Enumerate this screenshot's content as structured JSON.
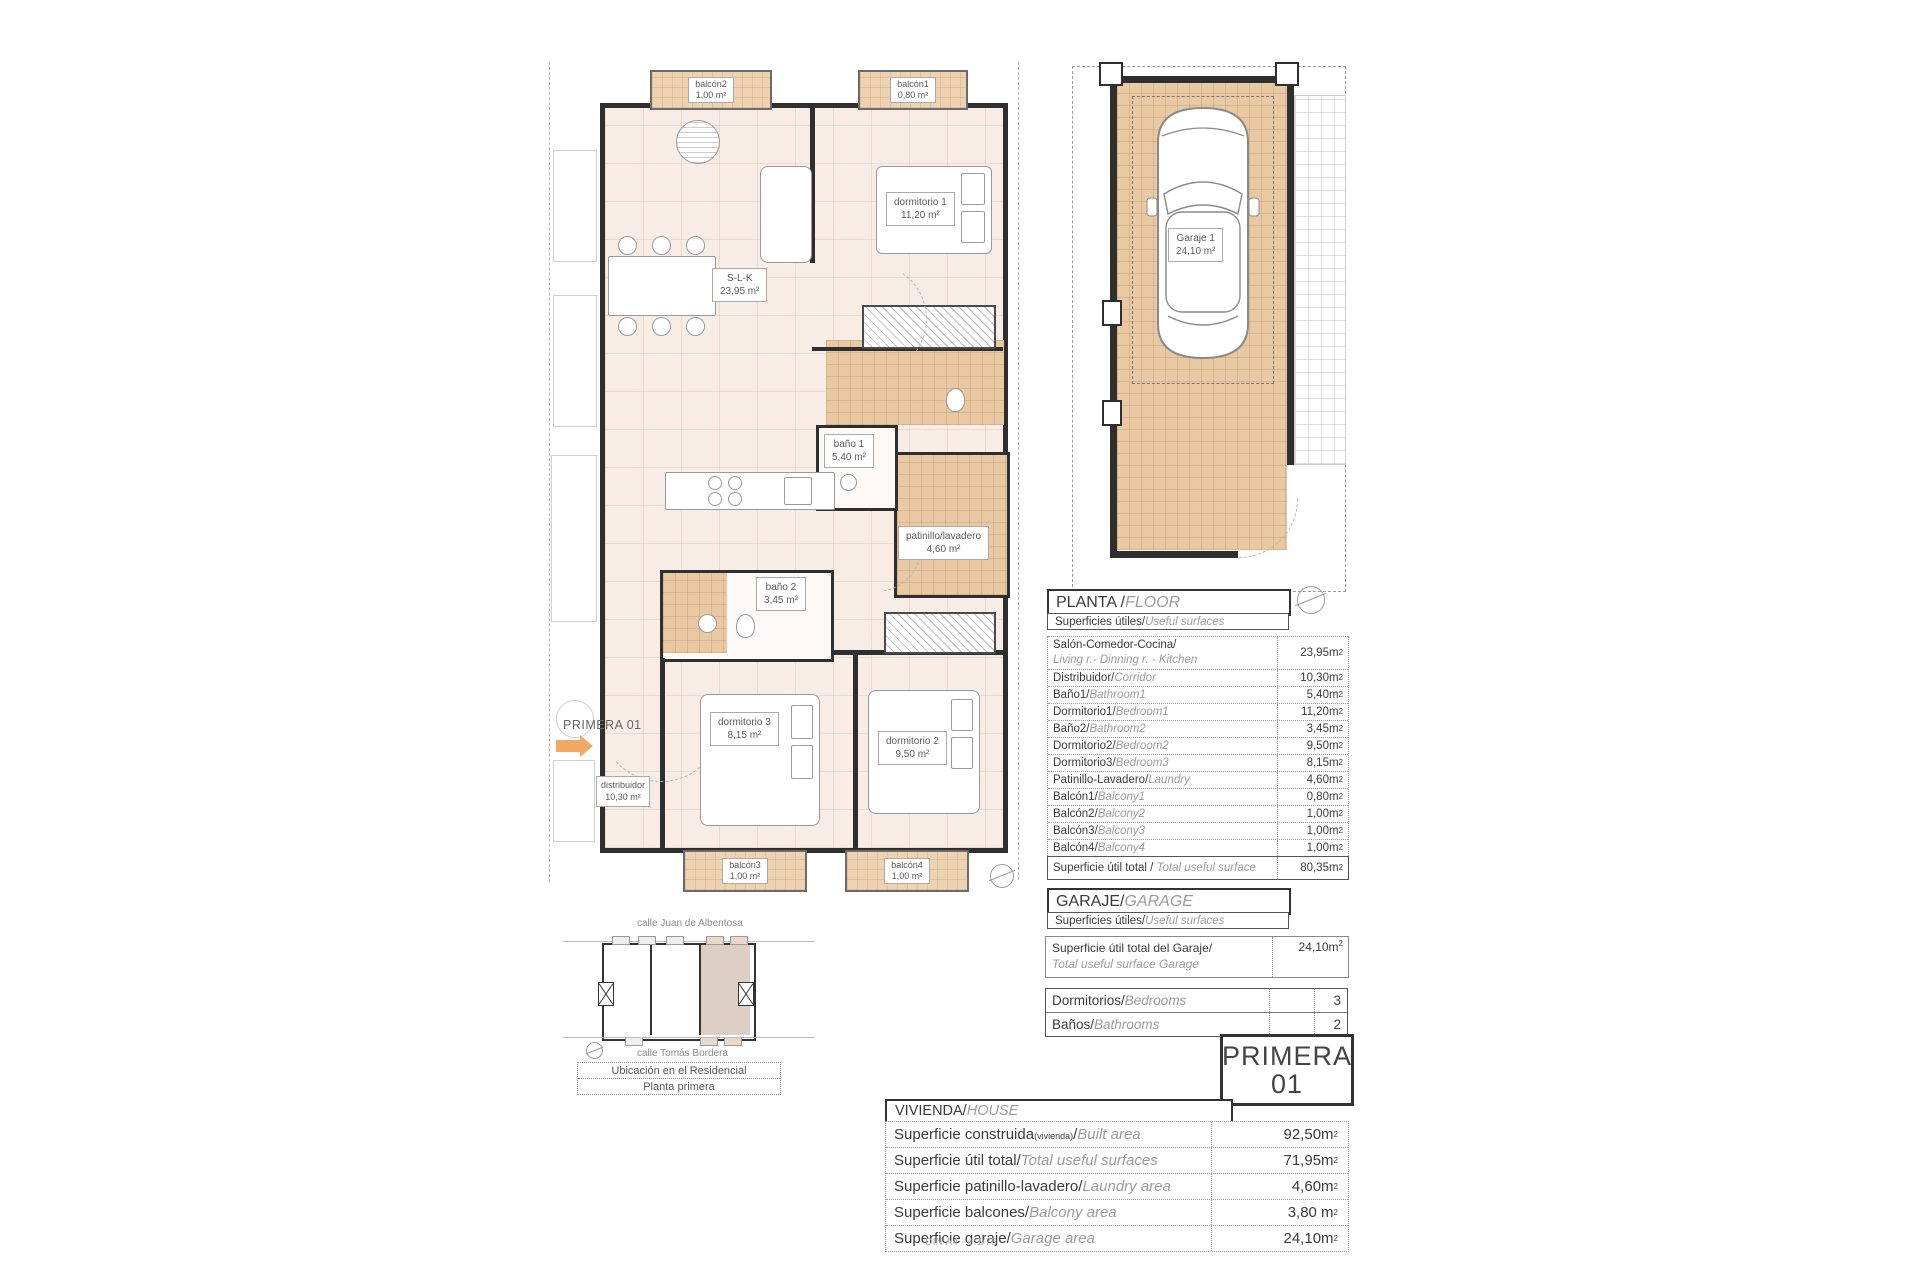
{
  "page": {
    "footer_note": "DIN A4 - e:1/75"
  },
  "floor_plan": {
    "unit_arrow_label": "PRIMERA 01",
    "rooms": {
      "balcon2": {
        "name": "balcón2",
        "area": "1,00 m²"
      },
      "balcon1": {
        "name": "balcón1",
        "area": "0,80 m²"
      },
      "dormitorio1": {
        "name": "dormitorio 1",
        "area": "11,20 m²"
      },
      "slk": {
        "name": "S-L-K",
        "area": "23,95 m²"
      },
      "bano1": {
        "name": "baño 1",
        "area": "5,40 m²"
      },
      "patinillo": {
        "name": "patinillo/lavadero",
        "area": "4,60 m²"
      },
      "bano2": {
        "name": "baño 2",
        "area": "3,45 m²"
      },
      "dormitorio3": {
        "name": "dormitorio 3",
        "area": "8,15 m²"
      },
      "dormitorio2": {
        "name": "dormitorio 2",
        "area": "9,50 m²"
      },
      "distribuidor": {
        "name": "distribuidor",
        "area": "10,30 m²"
      },
      "balcon3": {
        "name": "balcón3",
        "area": "1,00 m²"
      },
      "balcon4": {
        "name": "balcón4",
        "area": "1,00 m²"
      }
    }
  },
  "garage_plan": {
    "name": "Garaje 1",
    "area": "24,10 m²"
  },
  "planta": {
    "title_es": "PLANTA / ",
    "title_en": "FLOOR",
    "subtitle_es": "Superficies útiles/",
    "subtitle_en": "Useful surfaces",
    "rows": [
      {
        "es": "Salón-Comedor-Cocina",
        "sep": "/",
        "en": "Living r.- Dinning r. - Kitchen",
        "value": "23,95m²",
        "two_line": true
      },
      {
        "es": "Distribuidor",
        "sep": "/",
        "en": "Corridor",
        "value": "10,30m²"
      },
      {
        "es": "Baño1",
        "sep": "/",
        "en": "Bathroom1",
        "value": "5,40m²"
      },
      {
        "es": "Dormitorio1",
        "sep": "/",
        "en": "Bedroom1",
        "value": "11,20m²"
      },
      {
        "es": "Baño2",
        "sep": "/",
        "en": "Bathroom2",
        "value": "3,45m²"
      },
      {
        "es": "Dormitorio2",
        "sep": "/",
        "en": "Bedroom2",
        "value": "9,50m²"
      },
      {
        "es": "Dormitorio3",
        "sep": "/",
        "en": "Bedroom3",
        "value": "8,15m²"
      },
      {
        "es": "Patinillo-Lavadero",
        "sep": "/",
        "en": "Laundry",
        "value": "4,60m²"
      },
      {
        "es": "Balcón1",
        "sep": "/",
        "en": "Balcony1",
        "value": "0,80m²"
      },
      {
        "es": "Balcón2",
        "sep": "/",
        "en": "Balcony2",
        "value": "1,00m²"
      },
      {
        "es": "Balcón3",
        "sep": "/",
        "en": "Balcony3",
        "value": "1,00m²"
      },
      {
        "es": "Balcón4",
        "sep": "/",
        "en": "Balcony4",
        "value": "1,00m²"
      }
    ],
    "total_row": {
      "es": "Superficie útil total",
      "sep": " / ",
      "en": "Total useful surface",
      "value": "80,35m²"
    }
  },
  "garaje_section": {
    "title_es": "GARAJE/",
    "title_en": "GARAGE",
    "subtitle_es": "Superficies útiles/",
    "subtitle_en": "Useful surfaces",
    "row": {
      "es": "Superficie útil total del Garaje",
      "sep": "/",
      "en": "Total useful surface Garage",
      "value": "24,10m²"
    }
  },
  "counts": {
    "rows": [
      {
        "es": "Dormitorios",
        "sep": "/",
        "en": "Bedrooms",
        "value": "3"
      },
      {
        "es": "Baños",
        "sep": "/",
        "en": "Bathrooms",
        "value": "2"
      }
    ]
  },
  "primera_box": {
    "line1": "PRIMERA",
    "line2": "01"
  },
  "vivienda": {
    "title_es": "VIVIENDA/",
    "title_en": "HOUSE",
    "rows": [
      {
        "es": "Superficie construida",
        "small": "(vivienda)",
        "sep": "/",
        "en": "Built area",
        "value": "92,50m²"
      },
      {
        "es": "Superficie útil total",
        "sep": "/",
        "en": "Total useful surfaces",
        "value": "71,95m²"
      },
      {
        "es": "Superficie patinillo-lavadero",
        "sep": "/",
        "en": "Laundry area",
        "value": "4,60m²"
      },
      {
        "es": "Superficie balcones",
        "sep": "/",
        "en": "Balcony area",
        "value": "3,80 m²"
      },
      {
        "es": "Superficie garaje",
        "sep": "/",
        "en": "Garage area",
        "value": "24,10m²"
      }
    ]
  },
  "site_plan": {
    "street_top": "calle Juan de Albentosa",
    "street_bottom": "calle Tomás Bordera",
    "caption_line1": "Ubicación en el Residencial",
    "caption_line2": "Planta primera"
  }
}
